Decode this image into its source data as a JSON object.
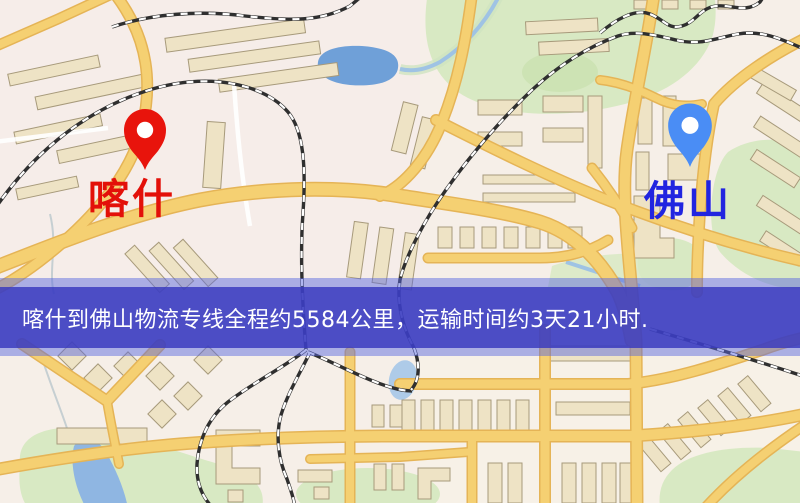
{
  "map": {
    "markers": [
      {
        "id": "origin",
        "city": "喀什",
        "icon": "map-pin",
        "pin_color": "#e8140c",
        "label_color": "#e31009"
      },
      {
        "id": "destination",
        "city": "佛山",
        "icon": "map-pin",
        "pin_color": "#4a8df5",
        "label_color": "#2225e0"
      }
    ],
    "banner": {
      "text": "喀什到佛山物流专线全程约5584公里，运输时间约3天21小时.",
      "origin": "喀什",
      "destination": "佛山",
      "distance_text": "约5584公里",
      "duration_text": "约3天21小时",
      "background_color": "#3a3abe",
      "text_color": "#ffffff"
    }
  }
}
